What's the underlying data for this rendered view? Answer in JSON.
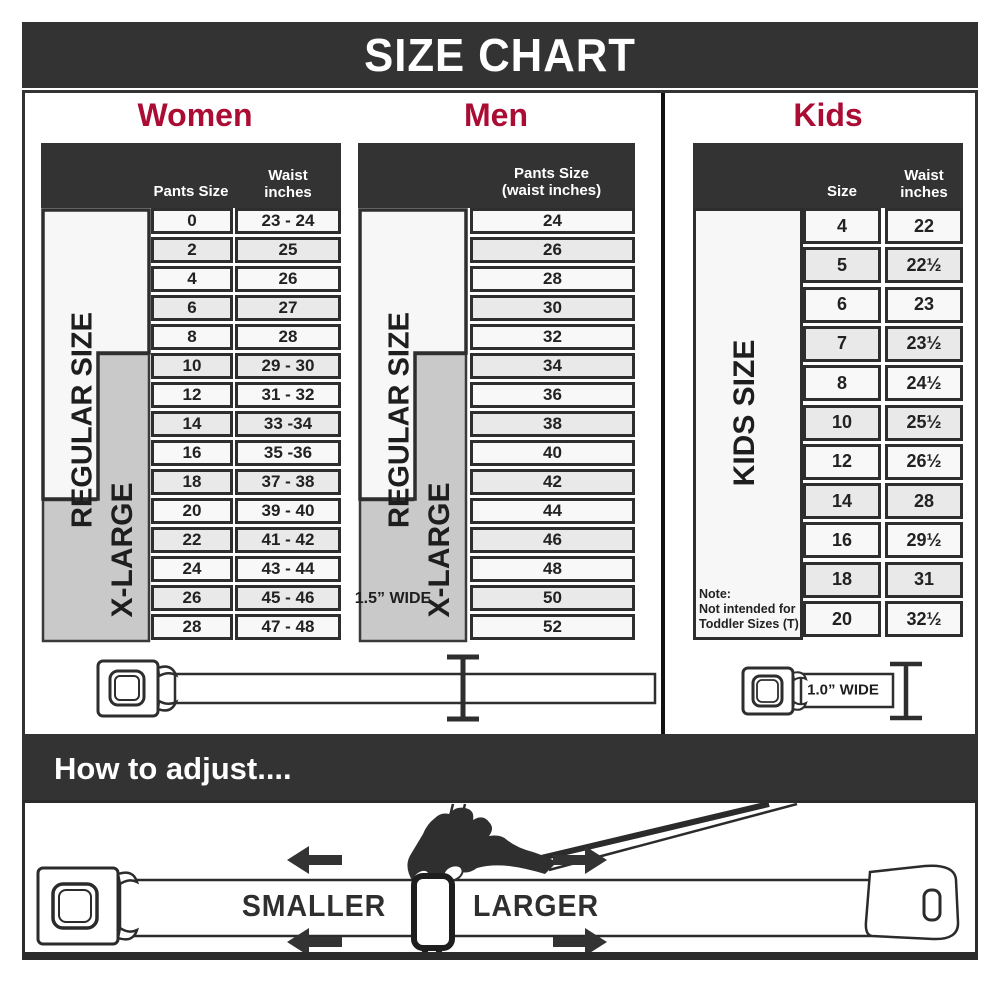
{
  "title": "SIZE CHART",
  "colors": {
    "band_charcoal": "#333333",
    "heading_crimson": "#ab0c34",
    "row_light": "#f8f8f8",
    "row_alt": "#e9e9e9",
    "xlarge_gray": "#c9c9c9",
    "cell_border": "#2e2e2e"
  },
  "panels": {
    "women": {
      "label": "Women",
      "pants_header": "Pants Size",
      "waist_header_line1": "Waist",
      "waist_header_line2": "inches",
      "regular_label": "REGULAR SIZE",
      "xlarge_label": "X-LARGE",
      "rows": [
        {
          "size": "0",
          "waist": "23 - 24"
        },
        {
          "size": "2",
          "waist": "25"
        },
        {
          "size": "4",
          "waist": "26"
        },
        {
          "size": "6",
          "waist": "27"
        },
        {
          "size": "8",
          "waist": "28"
        },
        {
          "size": "10",
          "waist": "29 - 30"
        },
        {
          "size": "12",
          "waist": "31 - 32"
        },
        {
          "size": "14",
          "waist": "33 -34"
        },
        {
          "size": "16",
          "waist": "35 -36"
        },
        {
          "size": "18",
          "waist": "37 - 38"
        },
        {
          "size": "20",
          "waist": "39 - 40"
        },
        {
          "size": "22",
          "waist": "41 - 42"
        },
        {
          "size": "24",
          "waist": "43 - 44"
        },
        {
          "size": "26",
          "waist": "45 - 46"
        },
        {
          "size": "28",
          "waist": "47 - 48"
        }
      ]
    },
    "men": {
      "label": "Men",
      "header_line1": "Pants Size",
      "header_line2": "(waist inches)",
      "regular_label": "REGULAR SIZE",
      "xlarge_label": "X-LARGE",
      "rows": [
        "24",
        "26",
        "28",
        "30",
        "32",
        "34",
        "36",
        "38",
        "40",
        "42",
        "44",
        "46",
        "48",
        "50",
        "52"
      ]
    },
    "kids": {
      "label": "Kids",
      "size_header": "Size",
      "waist_header_line1": "Waist",
      "waist_header_line2": "inches",
      "side_label": "KIDS SIZE",
      "note_line1": "Note:",
      "note_line2": "Not intended for",
      "note_line3": "Toddler Sizes (T)",
      "rows": [
        {
          "size": "4",
          "waist": "22"
        },
        {
          "size": "5",
          "waist": "22½"
        },
        {
          "size": "6",
          "waist": "23"
        },
        {
          "size": "7",
          "waist": "23½"
        },
        {
          "size": "8",
          "waist": "24½"
        },
        {
          "size": "10",
          "waist": "25½"
        },
        {
          "size": "12",
          "waist": "26½"
        },
        {
          "size": "14",
          "waist": "28"
        },
        {
          "size": "16",
          "waist": "29½"
        },
        {
          "size": "18",
          "waist": "31"
        },
        {
          "size": "20",
          "waist": "32½"
        }
      ]
    }
  },
  "belts": {
    "adult_label": "1.5” WIDE",
    "kids_label": "1.0” WIDE"
  },
  "adjust": {
    "heading": "How to adjust....",
    "smaller_label": "SMALLER",
    "larger_label": "LARGER"
  }
}
